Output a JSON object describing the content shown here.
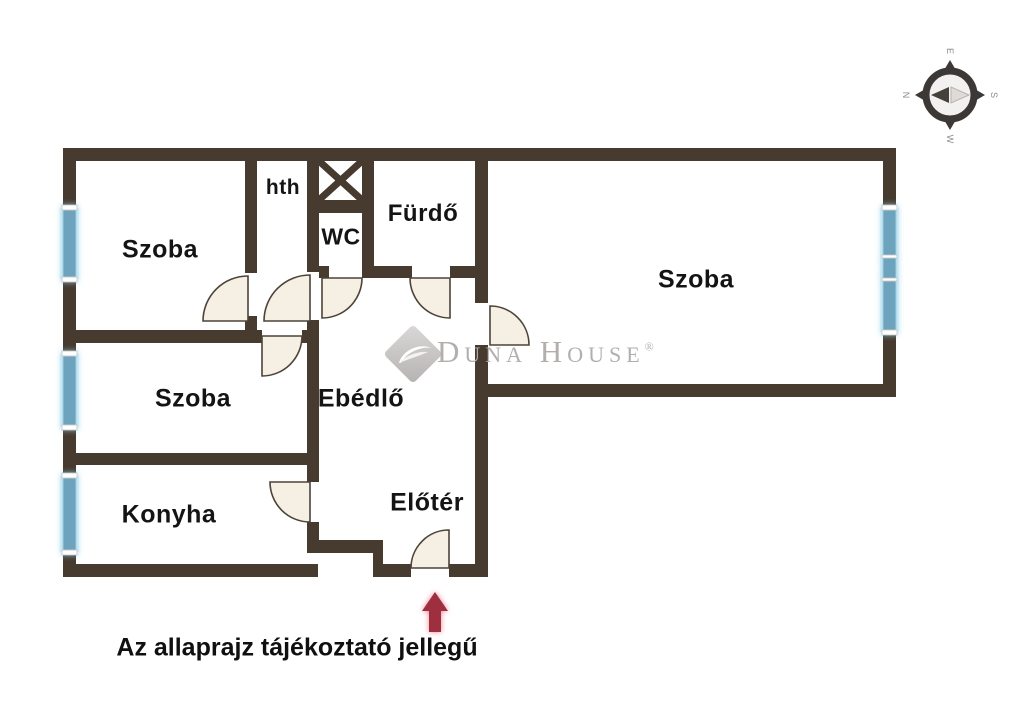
{
  "rooms": [
    {
      "id": "szoba-top-left",
      "label": "Szoba"
    },
    {
      "id": "hth",
      "label": "hth"
    },
    {
      "id": "wc",
      "label": "WC"
    },
    {
      "id": "furdo",
      "label": "Fürdő"
    },
    {
      "id": "szoba-right",
      "label": "Szoba"
    },
    {
      "id": "ebedlo",
      "label": "Ebédlő"
    },
    {
      "id": "szoba-middle",
      "label": "Szoba"
    },
    {
      "id": "konyha",
      "label": "Konyha"
    },
    {
      "id": "eloter",
      "label": "Előtér"
    }
  ],
  "compass": {
    "top": "E",
    "right": "S",
    "bottom": "W",
    "left": "N"
  },
  "watermark": {
    "brand": "Duna House",
    "registered": "®"
  },
  "footer": {
    "disclaimer": "Az allaprajz tájékoztató jellegű"
  },
  "colors": {
    "background": "#ffffff",
    "wall": "#473a2f",
    "window": "#6da3bc",
    "window_glow": "#bfe4f2",
    "door_fill": "#f6efe3",
    "door_stroke": "#4d4339",
    "label": "#141414",
    "watermark": "#b2afad",
    "arrow": "#9e2f3f"
  }
}
